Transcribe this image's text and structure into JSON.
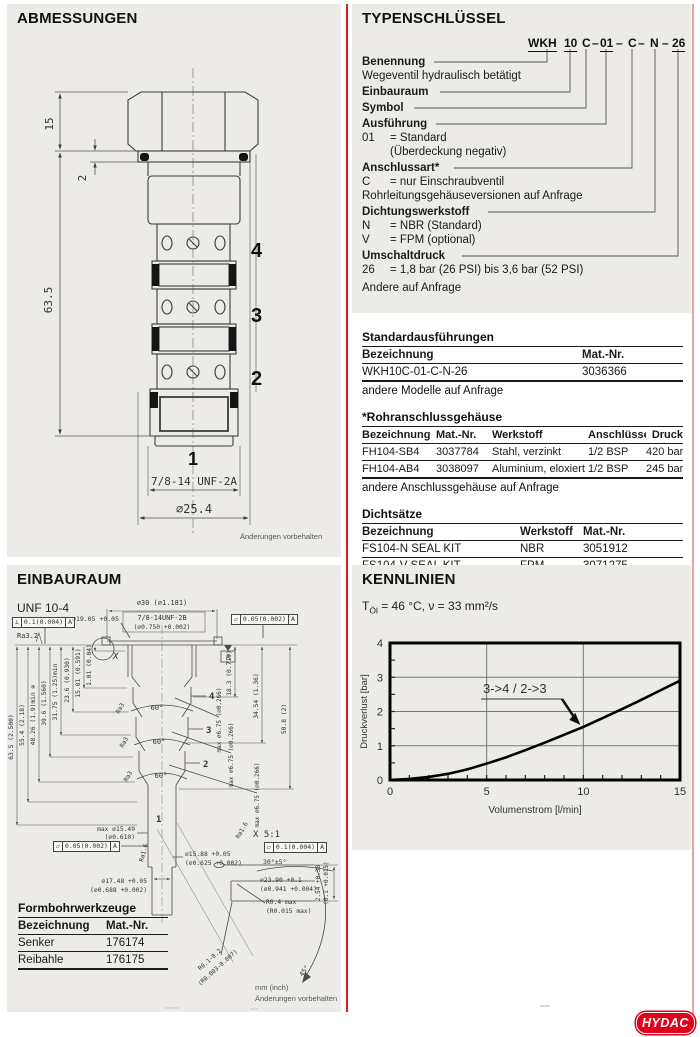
{
  "page": {
    "brand": "HYDAC",
    "brand_color": "#e2001a",
    "divider_color": "#cc2127"
  },
  "abmessungen": {
    "title": "ABMESSUNGEN",
    "dim_head_height": "15",
    "dim_seal_thickness": "2",
    "dim_body_length": "63.5",
    "port_4": "4",
    "port_3": "3",
    "port_2": "2",
    "port_1": "1",
    "thread": "7/8-14 UNF-2A",
    "diameter": "⌀25.4",
    "note": "Änderungen vorbehalten"
  },
  "typenschluessel": {
    "title": "TYPENSCHLÜSSEL",
    "code": {
      "p1": "WKH",
      "p2": "10",
      "p3": "C",
      "p4": "01",
      "p5": "C",
      "p6": "N",
      "p7": "26",
      "dash": "–"
    },
    "benennung_label": "Benennung",
    "benennung_desc": "Wegeventil hydraulisch betätigt",
    "einbauraum_label": "Einbauraum",
    "symbol_label": "Symbol",
    "ausfuehrung_label": "Ausführung",
    "ausfuehrung_k": "01",
    "ausfuehrung_v": "= Standard",
    "ausfuehrung_v2": "(Überdeckung negativ)",
    "anschlussart_label": "Anschlussart*",
    "anschlussart_k": "C",
    "anschlussart_v": "= nur Einschraubventil",
    "anschlussart_note": "Rohrleitungsgehäuseversionen auf Anfrage",
    "dichtung_label": "Dichtungswerkstoff",
    "dichtung_k1": "N",
    "dichtung_v1": "= NBR (Standard)",
    "dichtung_k2": "V",
    "dichtung_v2": "= FPM (optional)",
    "umschalt_label": "Umschaltdruck",
    "umschalt_k": "26",
    "umschalt_v": "= 1,8 bar (26 PSI) bis 3,6 bar (52 PSI)",
    "umschalt_note": "Andere auf Anfrage"
  },
  "tables": {
    "standard": {
      "title": "Standardausführungen",
      "headers": [
        "Bezeichnung",
        "Mat.-Nr."
      ],
      "rows": [
        [
          "WKH10C-01-C-N-26",
          "3036366"
        ]
      ],
      "note": "andere Modelle auf Anfrage"
    },
    "gehaeuse": {
      "title": "*Rohranschlussgehäuse",
      "headers": [
        "Bezeichnung",
        "Mat.-Nr.",
        "Werkstoff",
        "Anschlüsse",
        "Druck"
      ],
      "rows": [
        [
          "FH104-SB4",
          "3037784",
          "Stahl, verzinkt",
          "1/2 BSP",
          "420 bar"
        ],
        [
          "FH104-AB4",
          "3038097",
          "Aluminium, eloxiert",
          "1/2 BSP",
          "245 bar"
        ]
      ],
      "note": "andere Anschlussgehäuse auf Anfrage"
    },
    "dichtsaetze": {
      "title": "Dichtsätze",
      "headers": [
        "Bezeichnung",
        "Werkstoff",
        "Mat.-Nr."
      ],
      "rows": [
        [
          "FS104-N  SEAL KIT",
          "NBR",
          "3051912"
        ],
        [
          "FS104-V  SEAL KIT",
          "FPM",
          "3071275"
        ]
      ]
    },
    "werkzeuge": {
      "title": "Formbohrwerkzeuge",
      "headers": [
        "Bezeichnung",
        "Mat.-Nr."
      ],
      "rows": [
        [
          "Senker",
          "176174"
        ],
        [
          "Reibahle",
          "176175"
        ]
      ]
    }
  },
  "einbauraum": {
    "title": "EINBAURAUM",
    "subtitle": "UNF 10-4",
    "spotface": "⌀30 (⌀1.181)",
    "thread": "7/8-14UNF-2B",
    "thread_inch": "(⌀0.750 +0.002)",
    "bore": "⌀19.05 +0.05",
    "ra32": "Ra3.2",
    "ra3": "Ra3",
    "ra16": "Ra1.6",
    "fcf_perp": {
      "sym": "⊥",
      "val": "0.1(0.004)",
      "ref": "A"
    },
    "fcf_flat005": {
      "sym": "▱",
      "val": "0.05(0.002)",
      "ref": "A"
    },
    "fcf_flat01": {
      "sym": "▱",
      "val": "0.1(0.004)",
      "ref": "A"
    },
    "datum": "A",
    "detail_mark": "X",
    "left_dims": [
      "63.5 (2.500)",
      "55.4 (2.18)",
      "48.26 (1.9)min ⊕",
      "39.6 (1.560)",
      "31.75 (1.25)min",
      "23.6 (0.930)",
      "15.01 (0.591)",
      "1.01 (0.04)"
    ],
    "right_dims": [
      "18.3 (0.719)",
      "34.54 (1.36)",
      "50.8 (2)"
    ],
    "cross_hole": "max ⌀6.75 (⌀0.266)",
    "chamfer": "60°",
    "ports": {
      "p4": "4",
      "p3": "3",
      "p2": "2",
      "p1": "1"
    },
    "stem": {
      "max_d": "max ⌀15.49",
      "max_d_inch": "(⌀0.610)",
      "d1588": "⌀15.88 +0.05",
      "d1588_inch": "(⌀0.625 +0.002)",
      "d1748": "⌀17.48 +0.05",
      "d1748_inch": "(⌀0.688 +0.002)"
    },
    "detail": {
      "title": "X 5:1",
      "angle30": "30°±5°",
      "d2390": "⌀23.90 +0.1",
      "d2390_inch": "(⌀0.941 +0.004)",
      "r04": "R0.4 max",
      "r04_inch": "(R0.015 max)",
      "depth": "2.54 +0.38",
      "depth_inch": "(0.1 +0.015)",
      "r0102": "R0.1-0.2",
      "r0102_inch": "(R0.003-0.007)",
      "angle45": "45°"
    },
    "units_note": "mm (inch)",
    "note": "Änderungen vorbehalten"
  },
  "kennlinien": {
    "title": "KENNLINIEN",
    "cond_t": "T",
    "cond_sub": "Öl",
    "cond_rest": "= 46 °C, ν = 33 mm²/s"
  },
  "chart_data": {
    "type": "line",
    "title": "KENNLINIEN",
    "xlabel": "Volumenstrom [l/min]",
    "ylabel": "Druckverlust [bar]",
    "xlim": [
      0,
      15
    ],
    "ylim": [
      0,
      4
    ],
    "xticks": [
      0,
      5,
      10,
      15
    ],
    "yticks": [
      0,
      1,
      2,
      3,
      4
    ],
    "x_minor_step": 1,
    "y_minor_step": 0.5,
    "grid": true,
    "legend_position": "none",
    "series": [
      {
        "name": "3->4 / 2->3",
        "x": [
          0,
          1,
          2,
          3,
          4,
          5,
          6,
          7,
          8,
          9,
          10,
          11,
          12,
          13,
          14,
          15
        ],
        "values": [
          0,
          0.03,
          0.09,
          0.18,
          0.31,
          0.48,
          0.66,
          0.87,
          1.09,
          1.32,
          1.55,
          1.81,
          2.07,
          2.34,
          2.62,
          2.9
        ]
      }
    ],
    "annotation": {
      "text": "3->4 / 2->3",
      "arrow_to": [
        10,
        1.55
      ]
    }
  },
  "footer": {
    "logo": "HYDAC"
  }
}
